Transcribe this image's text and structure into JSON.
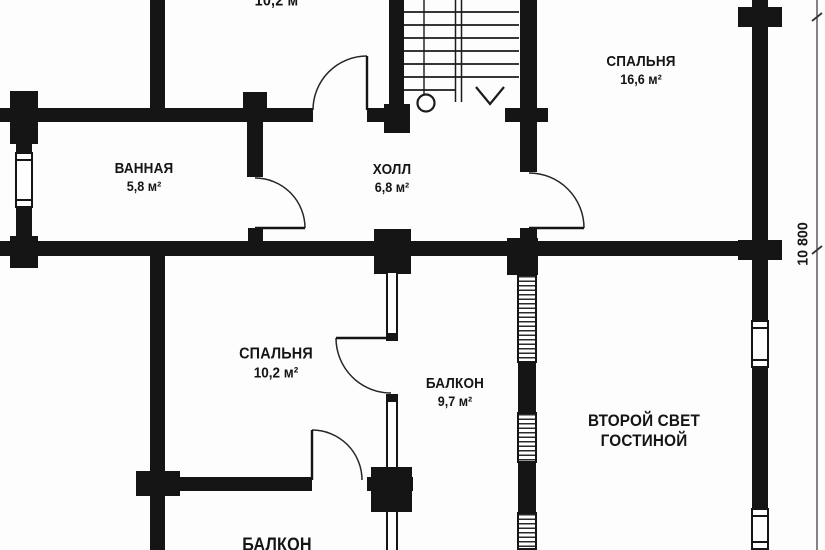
{
  "plan": {
    "type": "floor-plan",
    "language": "ru",
    "rooms": {
      "top_room": {
        "area": "10,2 м²"
      },
      "bedroom1": {
        "name": "СПАЛЬНЯ",
        "area": "16,6 м²"
      },
      "bathroom": {
        "name": "ВАННАЯ",
        "area": "5,8 м²"
      },
      "hall": {
        "name": "ХОЛЛ",
        "area": "6,8 м²"
      },
      "bedroom2": {
        "name": "СПАЛЬНЯ",
        "area": "10,2 м²"
      },
      "balcony1": {
        "name": "БАЛКОН",
        "area": "9,7 м²"
      },
      "second_light": {
        "line1": "ВТОРОЙ СВЕТ",
        "line2": "ГОСТИНОЙ"
      },
      "balcony2": {
        "name": "БАЛКОН"
      }
    },
    "dimension": {
      "value": "10 800"
    },
    "colors": {
      "wall": "#151515",
      "background": "#fdfdfd",
      "line": "#222222"
    }
  }
}
